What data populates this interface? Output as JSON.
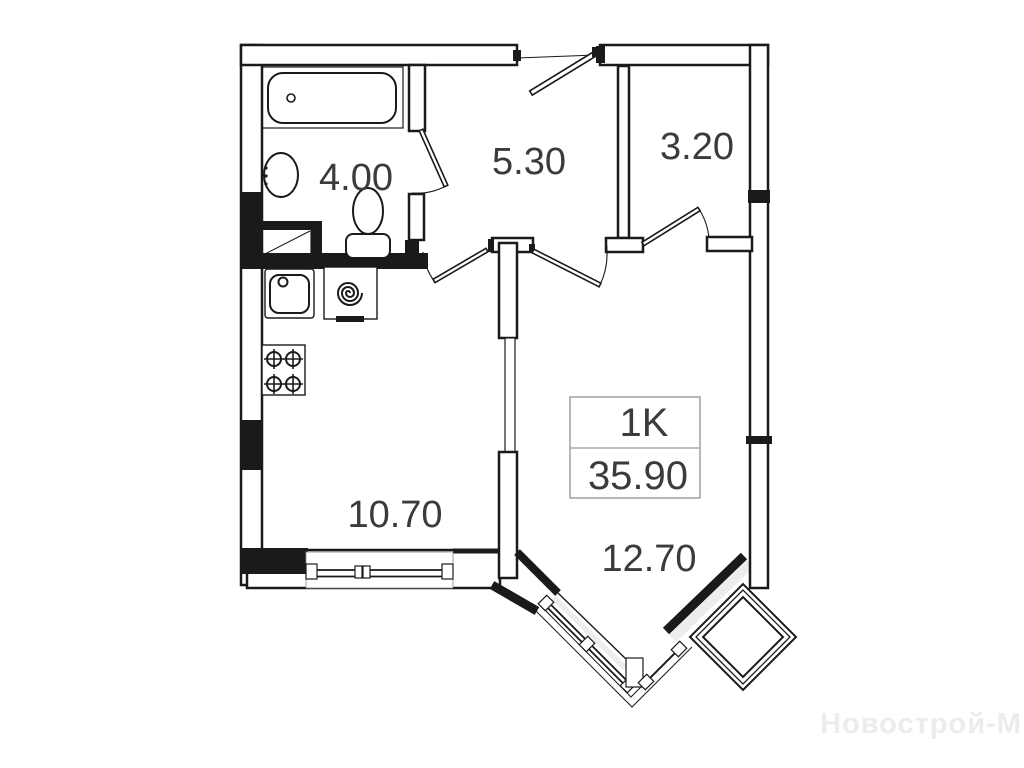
{
  "plan": {
    "info_box": {
      "unit_type": "1K",
      "total_area": "35.90"
    },
    "rooms": {
      "bathroom": "4.00",
      "hallway": "5.30",
      "storage": "3.20",
      "kitchen": "10.70",
      "living": "12.70"
    },
    "watermark": "Новострой-М",
    "colors": {
      "line": "#1a1a1a",
      "label": "#3b3b3b",
      "info_border": "#999999",
      "watermark": "#ececec",
      "background": "#ffffff"
    }
  }
}
